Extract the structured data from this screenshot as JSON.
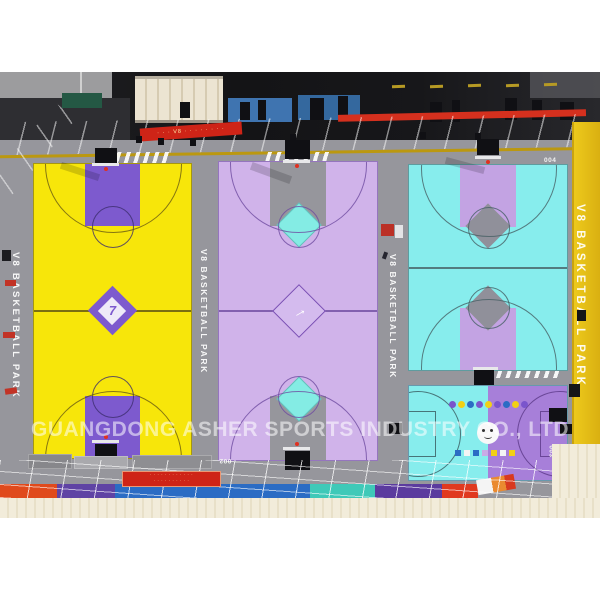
{
  "photo": {
    "watermark": "GUANGDONG ASHER SPORTS INDUSTRY CO., LTD",
    "park_label": "V8 BASKETBALL PARK",
    "top_banner_text": "· · · V8 · · · · · · · ·",
    "bottom_sign_line1": "· · · · · · · · · · · ·",
    "bottom_sign_line2": "· · · · · · · · · ·",
    "courts": [
      {
        "id": "court-1",
        "number": "001",
        "floor": "#f7e60a",
        "key": "#7d5ace",
        "line": "#6b5b14",
        "center_diamond": "#7d5ace"
      },
      {
        "id": "court-2",
        "number": "002",
        "floor": "#d0b3ea",
        "key": "#96969c",
        "line": "#7a4fb4",
        "key_diamond": "#84ece4"
      },
      {
        "id": "court-3",
        "number": "004",
        "floor": "#87eded",
        "key": "#c3a3e3",
        "line": "#4b6b6e",
        "key_diamond": "#90909a"
      },
      {
        "id": "court-kids",
        "number": "003",
        "floor_left": "#87eded",
        "floor_right": "#a77fd9",
        "dot_colors": [
          "#7a55cc",
          "#f2d014",
          "#2b6cc4",
          "#7a55cc",
          "#f2d014",
          "#7a55cc",
          "#2b6cc4",
          "#f2d014",
          "#7a55cc"
        ],
        "square_colors": [
          "#2b6cc4",
          "#f4f4f4",
          "#2b6cc4",
          "#c9abe6",
          "#f2d014",
          "#f4f4f4",
          "#f2d014"
        ]
      }
    ],
    "logo_glyphs": {
      "court1": "7",
      "court2": "→"
    },
    "colors": {
      "surround_gray": "#96969c",
      "canopy_yellow": "#eec615",
      "roof_dark": "#17171a",
      "banner_red": "#ce2417",
      "wall_cream": "#f0ead8",
      "strip_colors": [
        "#e04a1c",
        "#5f43a4",
        "#2b6cc4",
        "#3fc9b8",
        "#5b3b9e",
        "#e0391f"
      ]
    }
  }
}
